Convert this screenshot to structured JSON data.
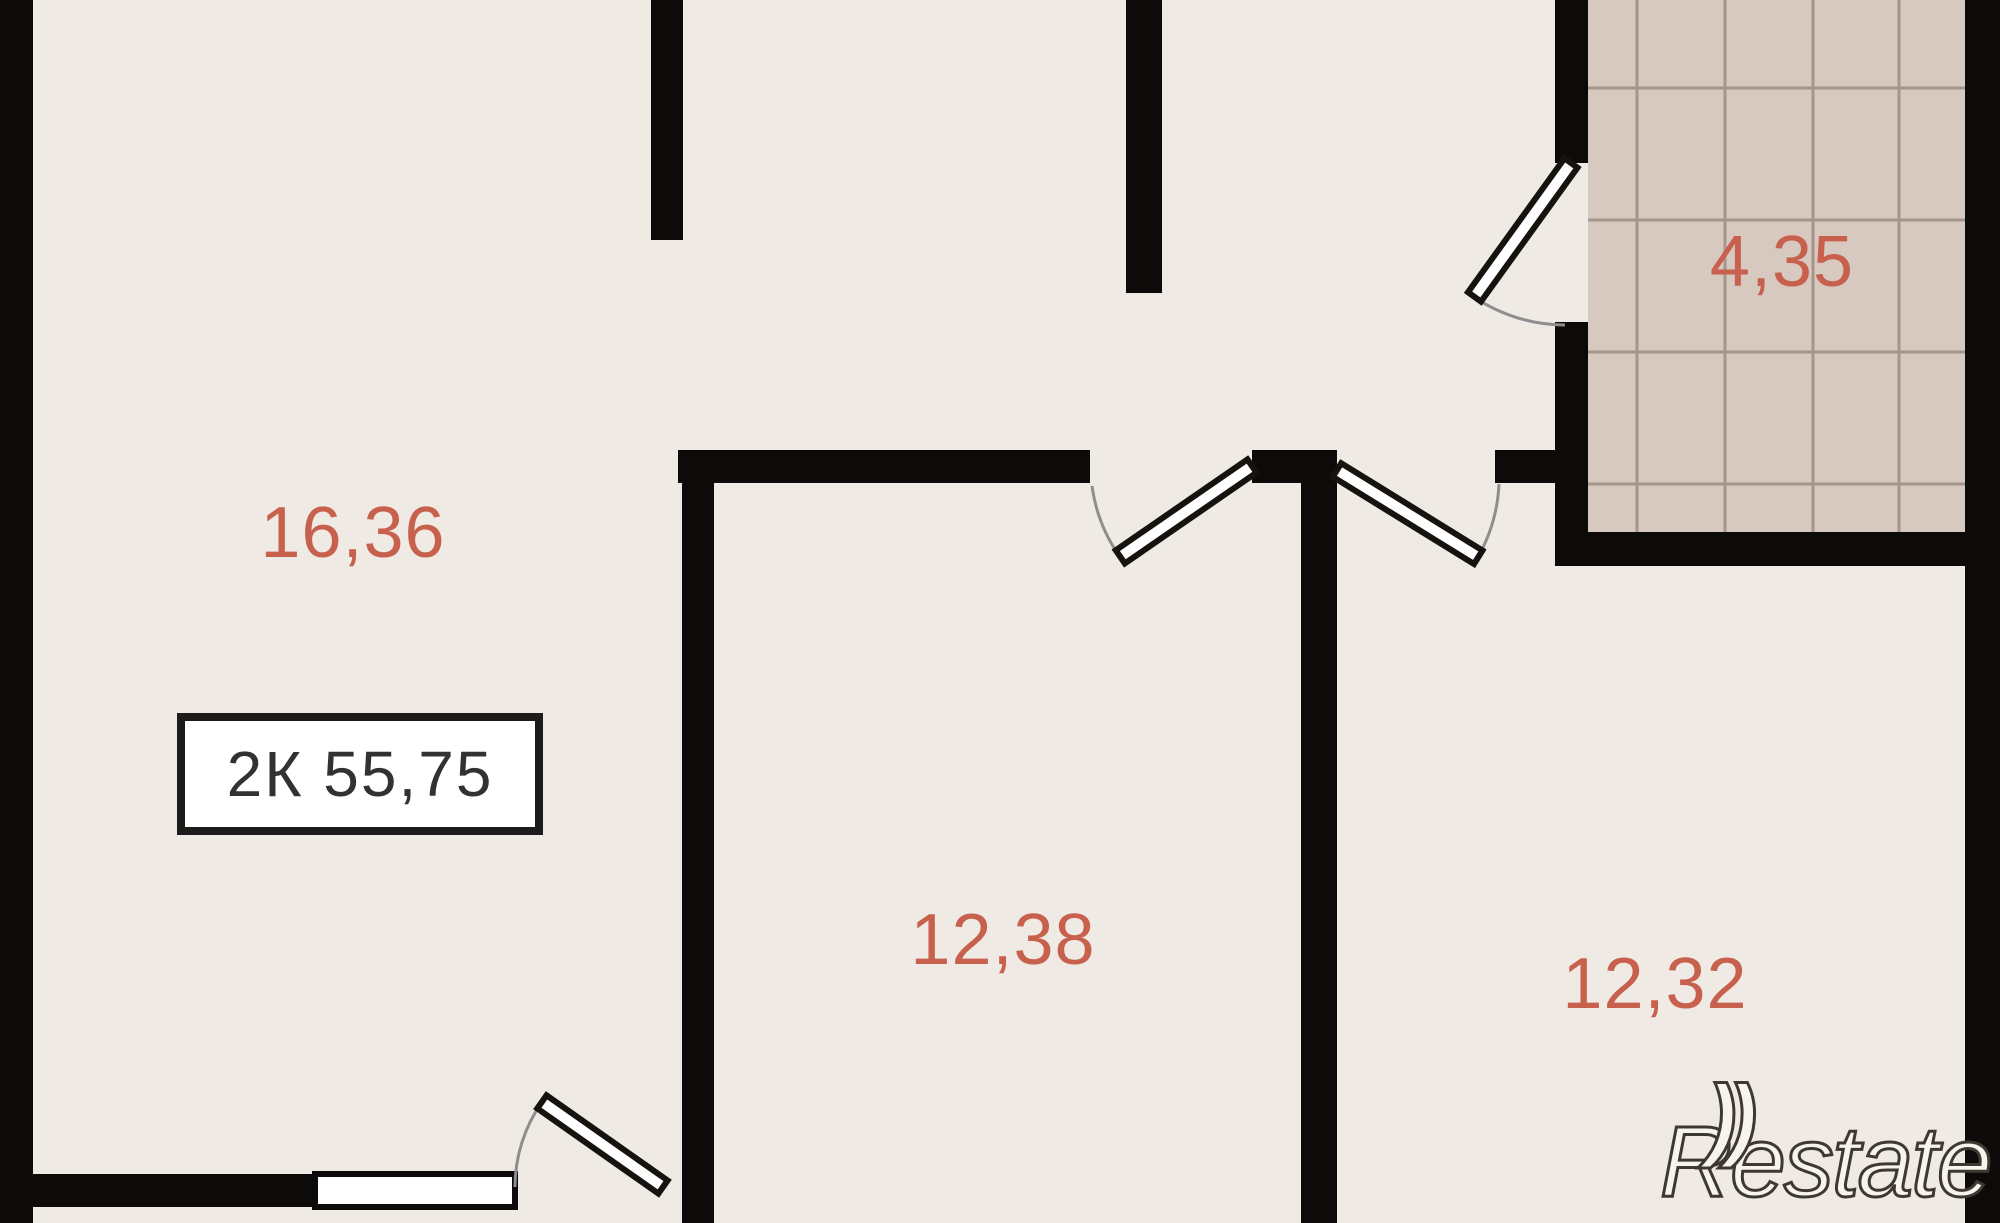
{
  "floorplan": {
    "unit_label": "2К 55,75",
    "rooms": [
      {
        "name": "living-room",
        "area_label": "16,36"
      },
      {
        "name": "room-middle",
        "area_label": "12,38"
      },
      {
        "name": "room-right",
        "area_label": "12,32"
      },
      {
        "name": "bathroom",
        "area_label": "4,35"
      }
    ],
    "watermark_text": "Restate",
    "watermark_arcs": "))"
  },
  "colors": {
    "background": "#f0eae5",
    "wall": "#0d0b09",
    "tile_fill": "#d7c8c0",
    "tile_line": "#a69689",
    "area_label": "#c7604c",
    "unit_box_fill": "#ffffff",
    "unit_box_border": "#1d1c1a",
    "unit_box_text": "#343230",
    "window_fill": "#ffffff",
    "door_leaf_fill": "#ffffff",
    "door_leaf_stroke": "#16130f",
    "door_arc": "#8e8e8e",
    "watermark_fill": "#f7f3ee",
    "watermark_outline": "#3e3831"
  }
}
